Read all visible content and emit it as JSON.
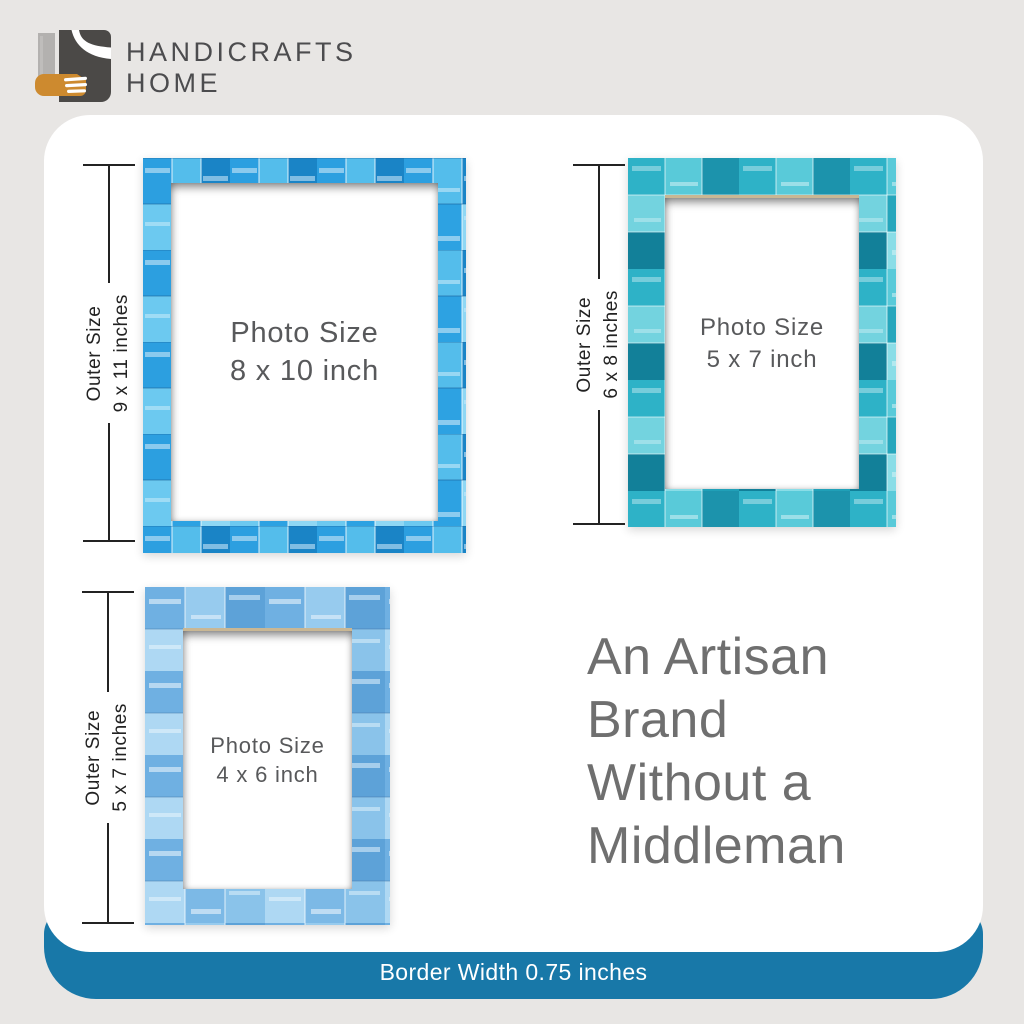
{
  "brand": {
    "name": "HANDICRAFTS\nHOME"
  },
  "frames": [
    {
      "id": "frame-8x10",
      "photo_label": "Photo Size\n8 x 10 inch",
      "outer_label": "Outer Size\n9 x 11 inches"
    },
    {
      "id": "frame-5x7",
      "photo_label": "Photo Size\n5 x 7 inch",
      "outer_label": "Outer Size\n6 x 8 inches"
    },
    {
      "id": "frame-4x6",
      "photo_label": "Photo Size\n4 x 6 inch",
      "outer_label": "Outer Size\n5 x 7 inches"
    }
  ],
  "tagline": {
    "text": "An Artisan\nBrand\nWithout a\nMiddleman"
  },
  "banner": {
    "label": "Border Width 0.75 inches"
  },
  "colors": {
    "banner_blue": "#1878a8",
    "background_gray": "#e8e6e4",
    "frame1_azure": "#2da2e2",
    "frame2_teal": "#26a6bc",
    "frame3_sky": "#7cb9e6",
    "logo_orange": "#cd8a2f"
  }
}
